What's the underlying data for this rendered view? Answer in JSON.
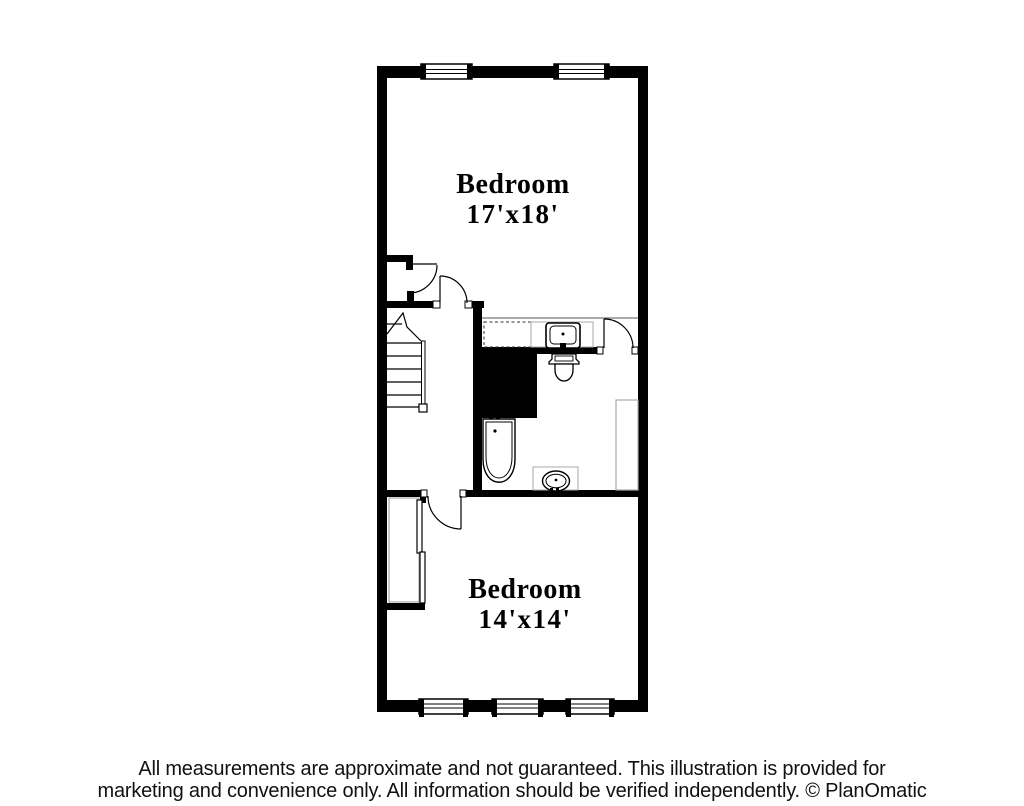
{
  "title": "Floor plan",
  "rooms": [
    {
      "name": "Bedroom",
      "dimensions": "17'x18'"
    },
    {
      "name": "Bedroom",
      "dimensions": "14'x14'"
    }
  ],
  "fixtures": [
    "staircase",
    "closet",
    "wardrobe-closet",
    "vanity-counter",
    "sink",
    "toilet",
    "bathtub",
    "vanity-sink",
    "built-in-cabinet",
    "window",
    "door-swing",
    "chase"
  ],
  "footer": {
    "line1": "All measurements are approximate and not guaranteed. This illustration is provided for",
    "line2": "marketing and convenience only. All information should be verified independently. © PlanOmatic"
  },
  "colors": {
    "wall": "#000000",
    "background": "#ffffff",
    "counter_outline": "#aaaaaa",
    "text": "#000000"
  }
}
